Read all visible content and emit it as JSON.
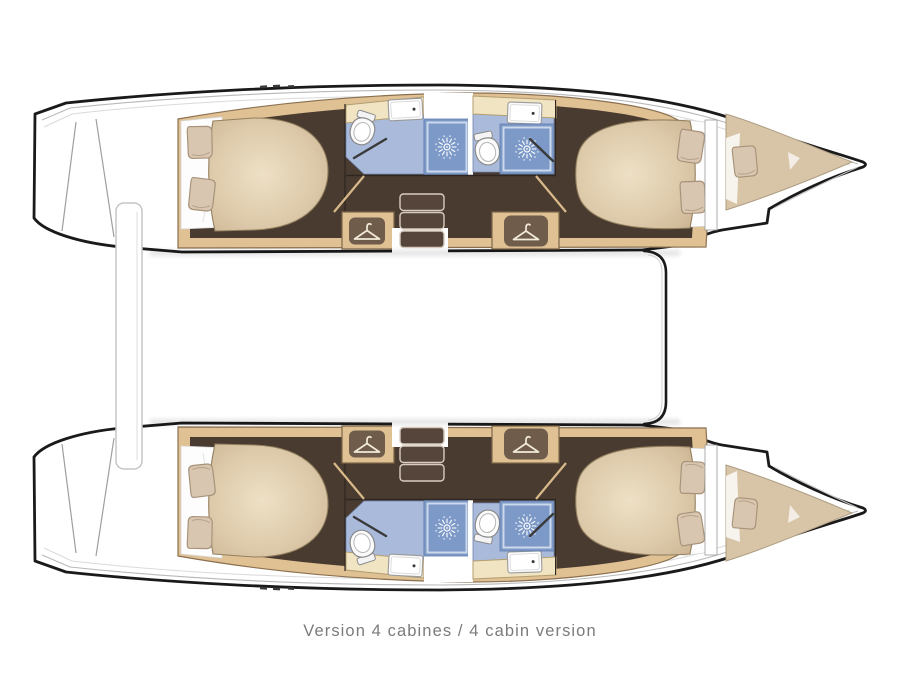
{
  "page": {
    "background": "#ffffff"
  },
  "caption": {
    "text": "Version 4 cabines / 4 cabin version",
    "color": "#7b7b7b"
  },
  "diagram": {
    "type": "boat-deck-plan",
    "subject": "catamaran interior layout, two hulls, bows pointing right",
    "hulls": [
      {
        "name": "top-hull",
        "rooms": [
          {
            "name": "aft-double-cabin",
            "features": [
              "double-bed",
              "two-pillows",
              "dark-wood-floor"
            ]
          },
          {
            "name": "aft-bathroom",
            "features": [
              "toilet",
              "sink",
              "shower-stall"
            ]
          },
          {
            "name": "forward-bathroom",
            "features": [
              "toilet",
              "sink",
              "shower-stall"
            ]
          },
          {
            "name": "companionway",
            "features": [
              "three-steps",
              "white-landing"
            ]
          },
          {
            "name": "wardrobe-aft",
            "features": [
              "hanger-icon"
            ]
          },
          {
            "name": "wardrobe-forward",
            "features": [
              "hanger-icon"
            ]
          },
          {
            "name": "forward-double-cabin",
            "features": [
              "double-bed",
              "two-pillows"
            ]
          },
          {
            "name": "forepeak",
            "features": [
              "v-berth-cushion",
              "pillow"
            ]
          },
          {
            "name": "transom",
            "features": [
              "swim-steps"
            ]
          }
        ]
      },
      {
        "name": "bottom-hull",
        "mirror_of": "top-hull"
      }
    ],
    "between_hulls": [
      "forward-crossbeam-line",
      "aft-gangway-bar"
    ],
    "icons": [
      {
        "name": "hanger-icon",
        "meaning": "wardrobe"
      },
      {
        "name": "shower-head-icon",
        "meaning": "shower stall"
      },
      {
        "name": "toilet-icon",
        "meaning": "toilet"
      },
      {
        "name": "sink-icon",
        "meaning": "washbasin"
      },
      {
        "name": "pillow-icon",
        "meaning": "bed pillow"
      }
    ]
  },
  "colors": {
    "background": "#ffffff",
    "hull_outline": "#1a1a1a",
    "deck_lines": "#b8b8b8",
    "wood_trim": "#dfc193",
    "counter_wood": "#f1e4c3",
    "floor_dark": "#4a3b30",
    "bed_tan": "#cdb695",
    "bed_highlight": "#eee0c5",
    "pillow": "#d8c6b0",
    "bathroom_floor": "#a9badb",
    "shower_floor": "#7d99c8",
    "step_tread": "#55453a",
    "caption_text": "#7b7b7b"
  }
}
